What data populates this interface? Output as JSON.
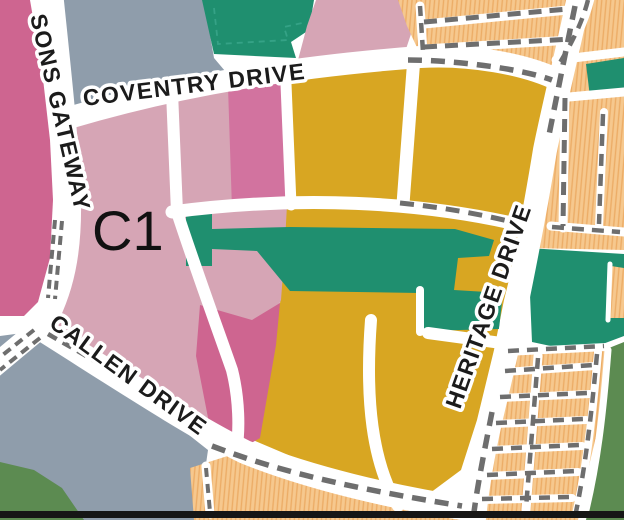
{
  "map": {
    "zone_label": "C1",
    "streets": {
      "sons_gateway": "SONS GATEWAY",
      "coventry": "COVENTRY DRIVE",
      "callen": "CALLEN DRIVE",
      "heritage": "HERITAGE DRIVE"
    },
    "colors": {
      "dark_pink": "#CE6590",
      "medium_pink": "#D2739F",
      "mauve": "#D6A5B5",
      "gold": "#D8A622",
      "teal": "#1F8F6F",
      "teal_dash": "#35A286",
      "open_green": "#5C8B51",
      "slate_gray": "#8F9DAB",
      "orange": "#F6C88E",
      "orange_hatch": "#ECAC66",
      "road_white": "#FFFFFF",
      "dash_gray": "#6E6E6E",
      "frame_black": "#161616"
    }
  }
}
